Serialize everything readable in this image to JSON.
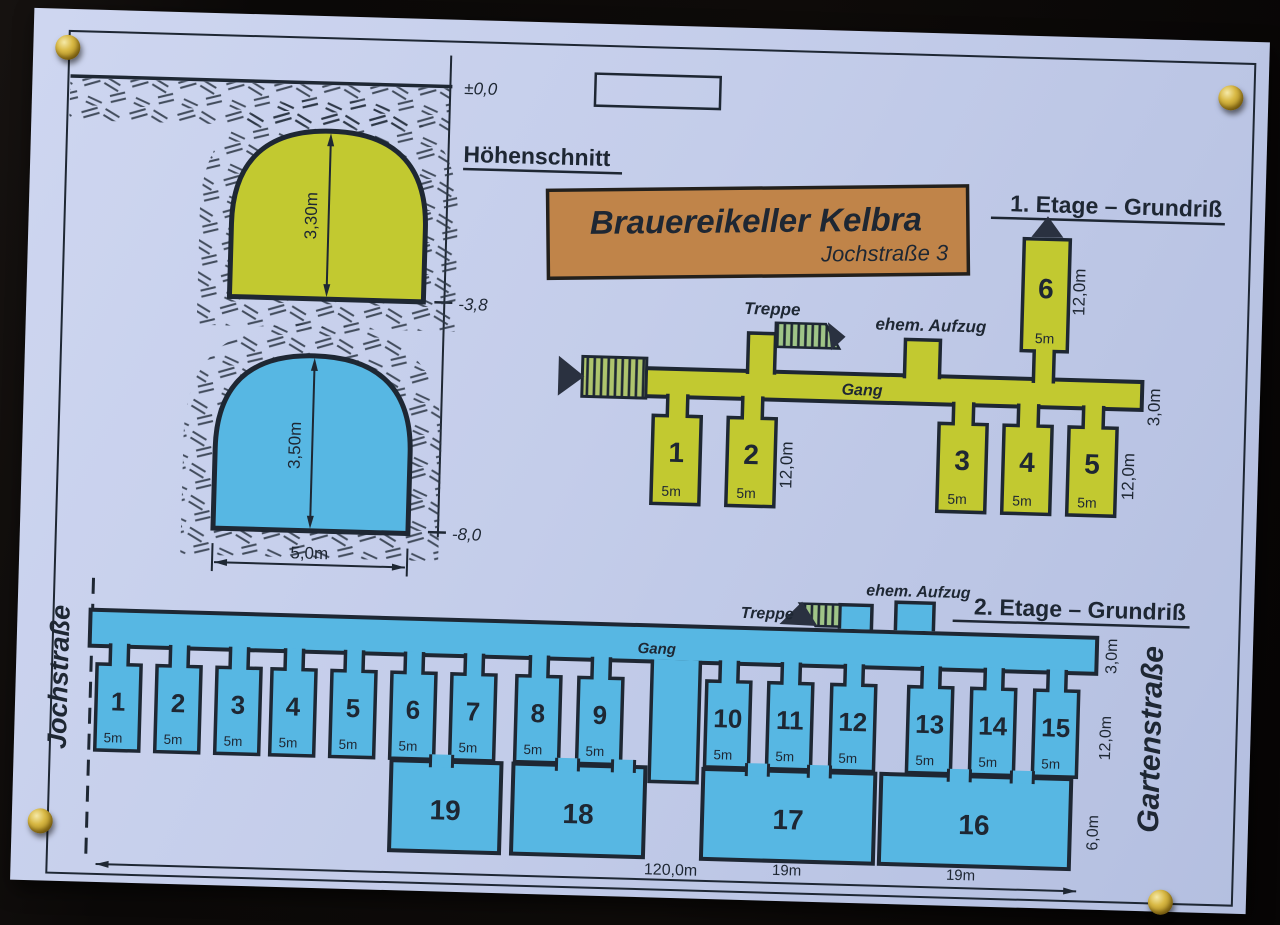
{
  "colors": {
    "background": "#0b0908",
    "paper": "#c4cdea",
    "ink": "#1e2733",
    "floor1_fill": "#c2c930",
    "floor2_fill": "#57b7e3",
    "sign_bg": "#c08449",
    "pin_brass": "#c7a62f"
  },
  "section": {
    "title": "Höhenschnitt",
    "level_top": "±0,0",
    "level_mid": "-3,8",
    "level_bottom": "-8,0",
    "upper_height": "3,30m",
    "lower_height": "3,50m",
    "width": "5,0m"
  },
  "sign": {
    "title": "Brauereikeller Kelbra",
    "subtitle": "Jochstraße 3"
  },
  "floor1": {
    "title": "1. Etage – Grundriß",
    "gang_label": "Gang",
    "treppe_label": "Treppe",
    "aufzug_label": "ehem. Aufzug",
    "room_depth": "12,0m",
    "corridor_width": "3,0m",
    "rooms": [
      {
        "no": "1",
        "width": "5m"
      },
      {
        "no": "2",
        "width": "5m"
      },
      {
        "no": "3",
        "width": "5m"
      },
      {
        "no": "4",
        "width": "5m"
      },
      {
        "no": "5",
        "width": "5m"
      },
      {
        "no": "6",
        "width": "5m"
      }
    ]
  },
  "floor2": {
    "title": "2. Etage – Grundriß",
    "gang_label": "Gang",
    "treppe_label": "Treppe",
    "aufzug_label": "ehem. Aufzug",
    "street_left": "Jochstraße",
    "street_right": "Gartenstraße",
    "room_depth": "12,0m",
    "corridor_width": "3,0m",
    "large_depth": "6,0m",
    "total_length": "120,0m",
    "rooms": [
      {
        "no": "1",
        "width": "5m"
      },
      {
        "no": "2",
        "width": "5m"
      },
      {
        "no": "3",
        "width": "5m"
      },
      {
        "no": "4",
        "width": "5m"
      },
      {
        "no": "5",
        "width": "5m"
      },
      {
        "no": "6",
        "width": "5m"
      },
      {
        "no": "7",
        "width": "5m"
      },
      {
        "no": "8",
        "width": "5m"
      },
      {
        "no": "9",
        "width": "5m"
      },
      {
        "no": "10",
        "width": "5m"
      },
      {
        "no": "11",
        "width": "5m"
      },
      {
        "no": "12",
        "width": "5m"
      },
      {
        "no": "13",
        "width": "5m"
      },
      {
        "no": "14",
        "width": "5m"
      },
      {
        "no": "15",
        "width": "5m"
      }
    ],
    "large_rooms": [
      {
        "no": "19",
        "width": ""
      },
      {
        "no": "18",
        "width": ""
      },
      {
        "no": "17",
        "width": "19m"
      },
      {
        "no": "16",
        "width": "19m"
      }
    ]
  }
}
